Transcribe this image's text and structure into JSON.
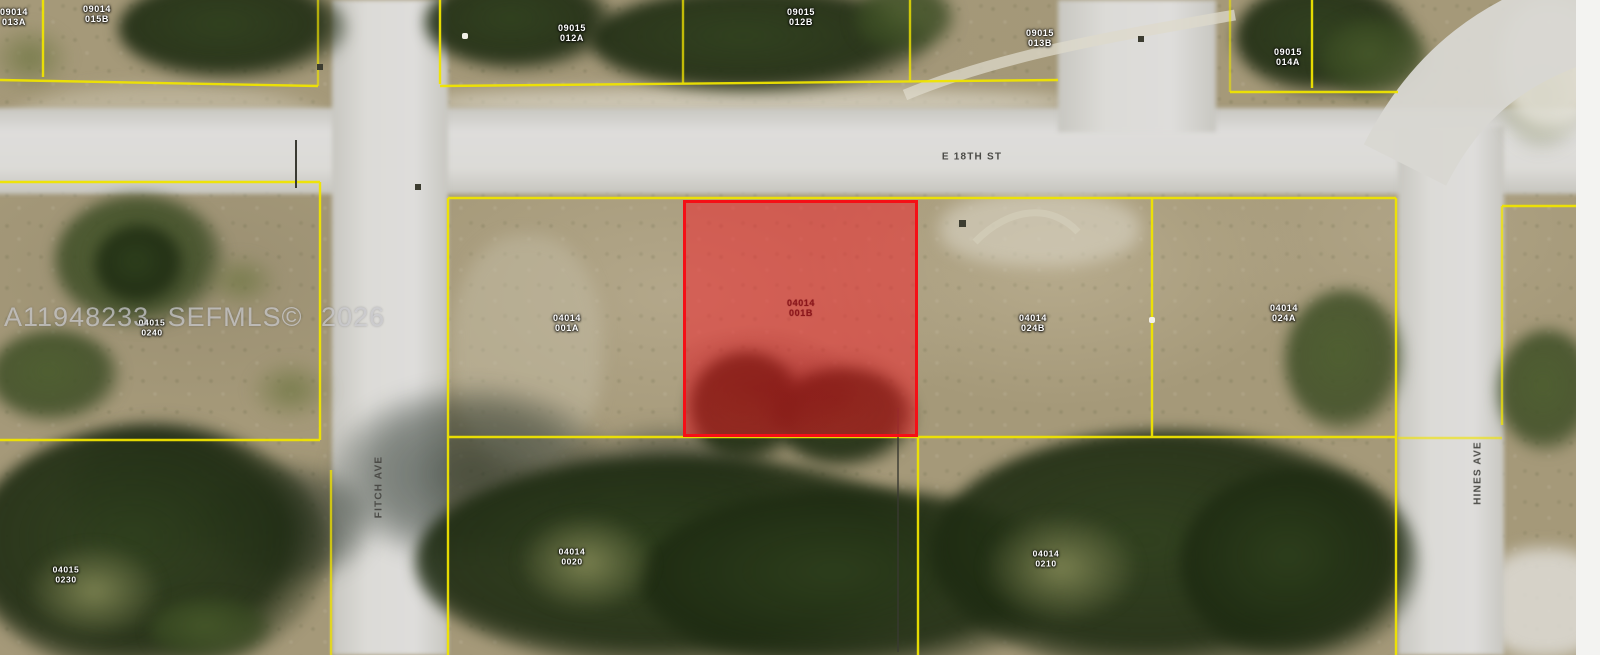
{
  "map": {
    "watermark": "A11948233 SEFMLS© 2026",
    "streets": {
      "e18th": "E 18TH ST",
      "fitch": "FITCH AVE",
      "hines": "HINES AVE"
    },
    "highlighted_parcel": {
      "line1": "04014",
      "line2": "001B"
    },
    "parcels": [
      {
        "line1": "09014",
        "line2": "013A"
      },
      {
        "line1": "09014",
        "line2": "015B"
      },
      {
        "line1": "09015",
        "line2": "012A"
      },
      {
        "line1": "09015",
        "line2": "012B"
      },
      {
        "line1": "09015",
        "line2": "013B"
      },
      {
        "line1": "09015",
        "line2": "014A"
      },
      {
        "line1": "04014",
        "line2": "001A"
      },
      {
        "line1": "04014",
        "line2": "024B"
      },
      {
        "line1": "04014",
        "line2": "024A"
      },
      {
        "line1": "04015",
        "line2": "0240"
      },
      {
        "line1": "04015",
        "line2": "0230"
      },
      {
        "line1": "04014",
        "line2": "0020"
      },
      {
        "line1": "04014",
        "line2": "0210"
      }
    ],
    "colors": {
      "highlight_fill": "#f22028",
      "highlight_border": "#f50f16",
      "parcel_line": "#f0e400",
      "road": "#d8d7d2",
      "ground": "#a79b7e",
      "vegetation": "#2f4420"
    }
  }
}
